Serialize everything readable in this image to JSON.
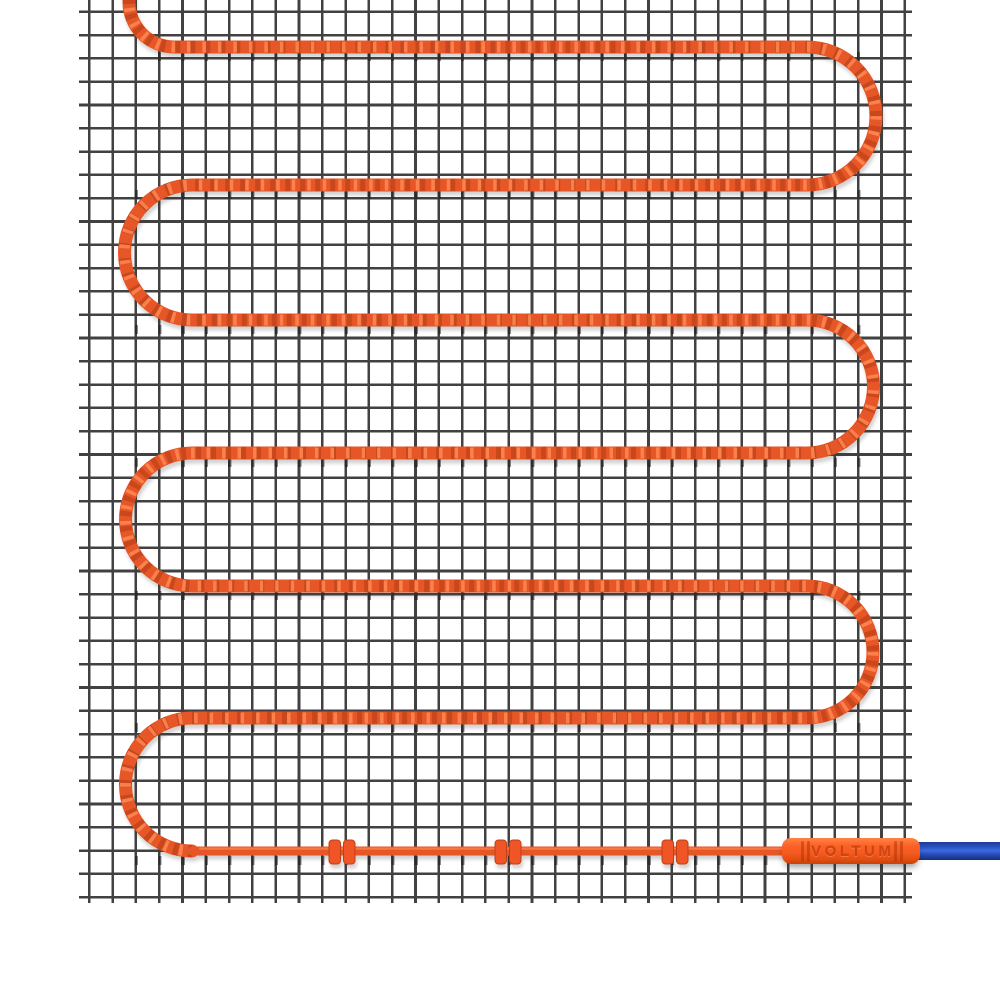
{
  "image": {
    "description": "Electric underfloor heating mat: orange serpentine heating cable laid on a dark wire mesh, joined by a branded splice connector to a blue power cord",
    "brand_label": "VOLTUM"
  },
  "colors": {
    "background": "#ffffff",
    "mesh_wire": "#414141",
    "heating_cable": "#e65628",
    "cable_shade": "#c2431a",
    "cable_highlight": "#ff8a55",
    "connector_orange": "#f55a20",
    "brand_text": "#cf4410",
    "power_cord_blue": "#2a52c4"
  },
  "structure": {
    "serpentine_rows": 7,
    "u_turns": 6,
    "fixing_clips": 3,
    "clip_positions_x": [
      342,
      508,
      675
    ],
    "power_cord_exit": "right edge"
  }
}
